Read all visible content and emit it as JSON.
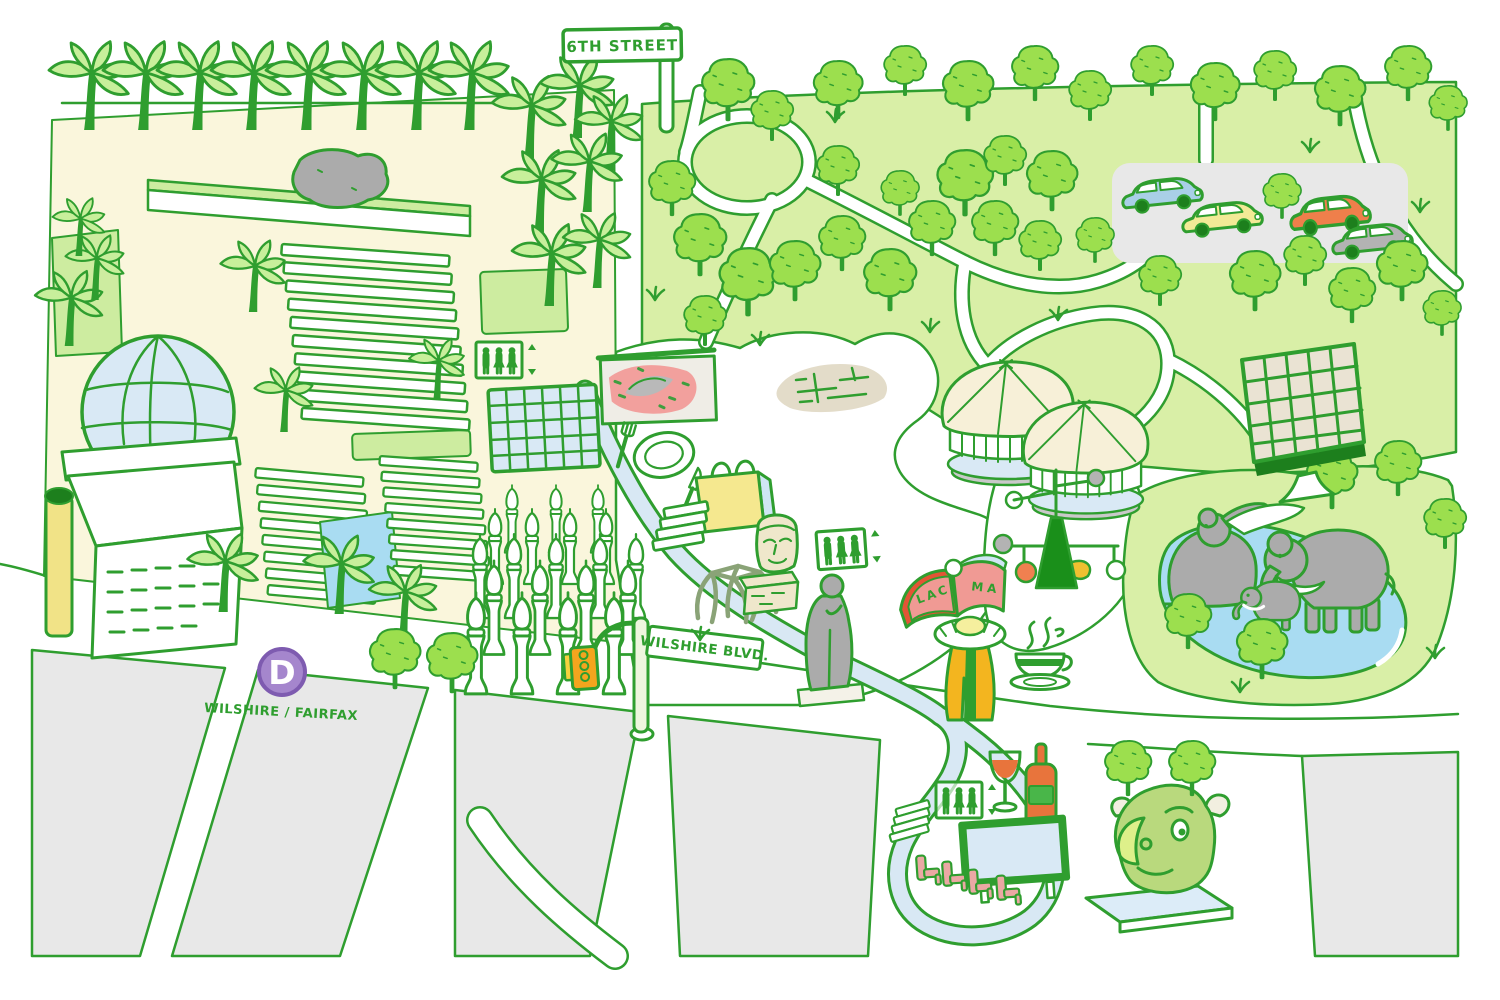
{
  "theme": {
    "ink": "#2f9e2f",
    "ink-dark": "#1d7f1d",
    "park": "#d9efa7",
    "lawn": "#cdeca0",
    "tree-fill": "#9cdf4e",
    "palm-fill": "#c8ef9b",
    "campus": "#faf6dc",
    "lake": "#a9dcf2",
    "ribbon": "#d8e8f4",
    "block": "#e8e8e8",
    "stone": "#ababab",
    "tan": "#efe7cb",
    "metro-purple": "#a586cd",
    "metro-rim": "#7e5bb0",
    "signal-orange": "#f4a51e",
    "bag-yellow": "#f5e88f",
    "art-pink": "#f2a09d",
    "wine": "#e8743c",
    "bottle-label": "#49b649",
    "seat-pink": "#eba8a4",
    "bull": "#b9d97d",
    "bull-muzzle": "#def08a",
    "car-blue": "#a9cfe7",
    "car-yellow": "#f2ea96",
    "car-orange": "#ef7f4b",
    "car-gray": "#b3b3b3",
    "robe": "#f3b51f",
    "book-red": "#e35535",
    "book-pink": "#f09a94",
    "page-blue": "#cfe6f4",
    "pav-roof": "#f7f0d8",
    "screen": "#d9e9f5",
    "platform": "#dcecf8",
    "pole": "#eef6de",
    "column-yellow": "#f1e387"
  },
  "signs": {
    "sixth_street": "6TH STREET",
    "wilshire_blvd": "WILSHIRE BLVD."
  },
  "station": {
    "line_letter": "D",
    "name": "WILSHIRE / FAIRFAX"
  },
  "book": {
    "left_page_text": "LAC",
    "right_page_text": "MA"
  }
}
